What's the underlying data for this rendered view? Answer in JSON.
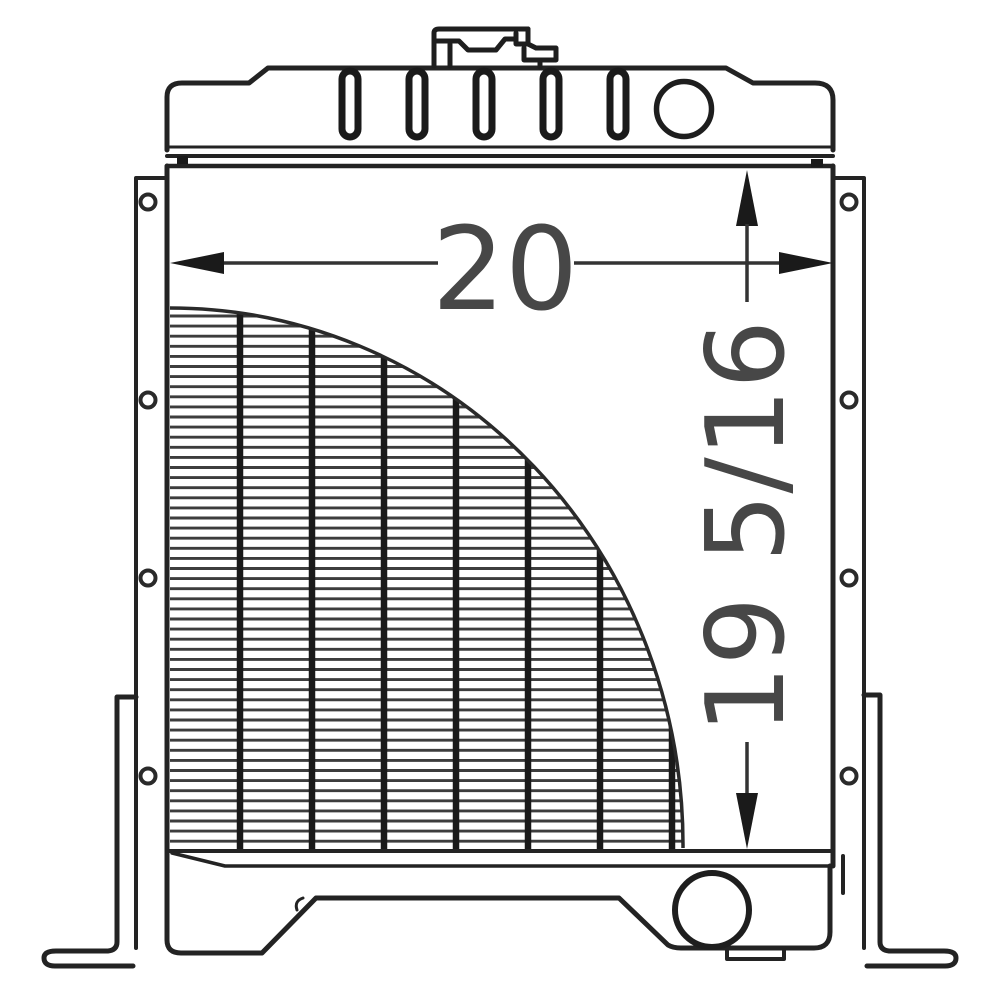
{
  "drawing": {
    "background_color": "#ffffff",
    "line_color": "#232323",
    "fin_line_color": "#3d3d3d",
    "arrow_color": "#1a1a1a",
    "dimension_text_color": "#474747",
    "width_dimension_label": "20",
    "height_dimension_label": "19 5/16",
    "vent_slot_count": 5,
    "mounting_hole_count_per_side": 4,
    "core_tube_line_count": 7,
    "core_fin_line_count": 53
  }
}
